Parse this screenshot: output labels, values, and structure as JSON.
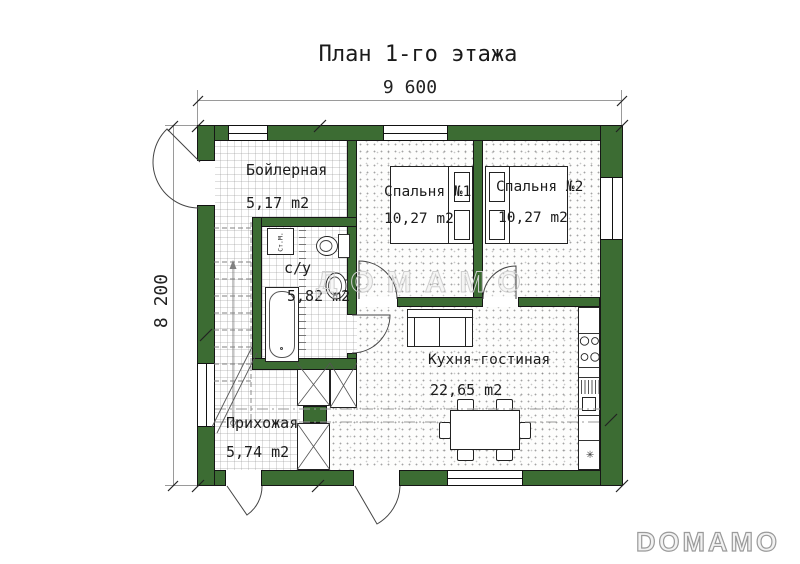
{
  "title": "План 1-го этажа",
  "dimensions": {
    "width_label": "9 600",
    "height_label": "8 200"
  },
  "rooms": {
    "boiler": {
      "name": "Бойлерная",
      "area": "5,17 m2"
    },
    "bedroom1": {
      "name": "Спальня №1",
      "area": "10,27 m2"
    },
    "bedroom2": {
      "name": "Спальня №2",
      "area": "10,27 m2"
    },
    "bathroom": {
      "name": "с/у",
      "area": "5,82 m2"
    },
    "kitchen_living": {
      "name": "Кухня-гостиная",
      "area": "22,65 m2"
    },
    "hallway": {
      "name": "Прихожая",
      "area": "5,74 m2"
    }
  },
  "appliances": {
    "washing_machine": "Ст.М.",
    "fridge_symbol": "✳"
  },
  "watermarks": {
    "center": "ДОМАМО",
    "bottom_right": "DOMAMO"
  },
  "colors": {
    "wall": "#3c6c33"
  }
}
